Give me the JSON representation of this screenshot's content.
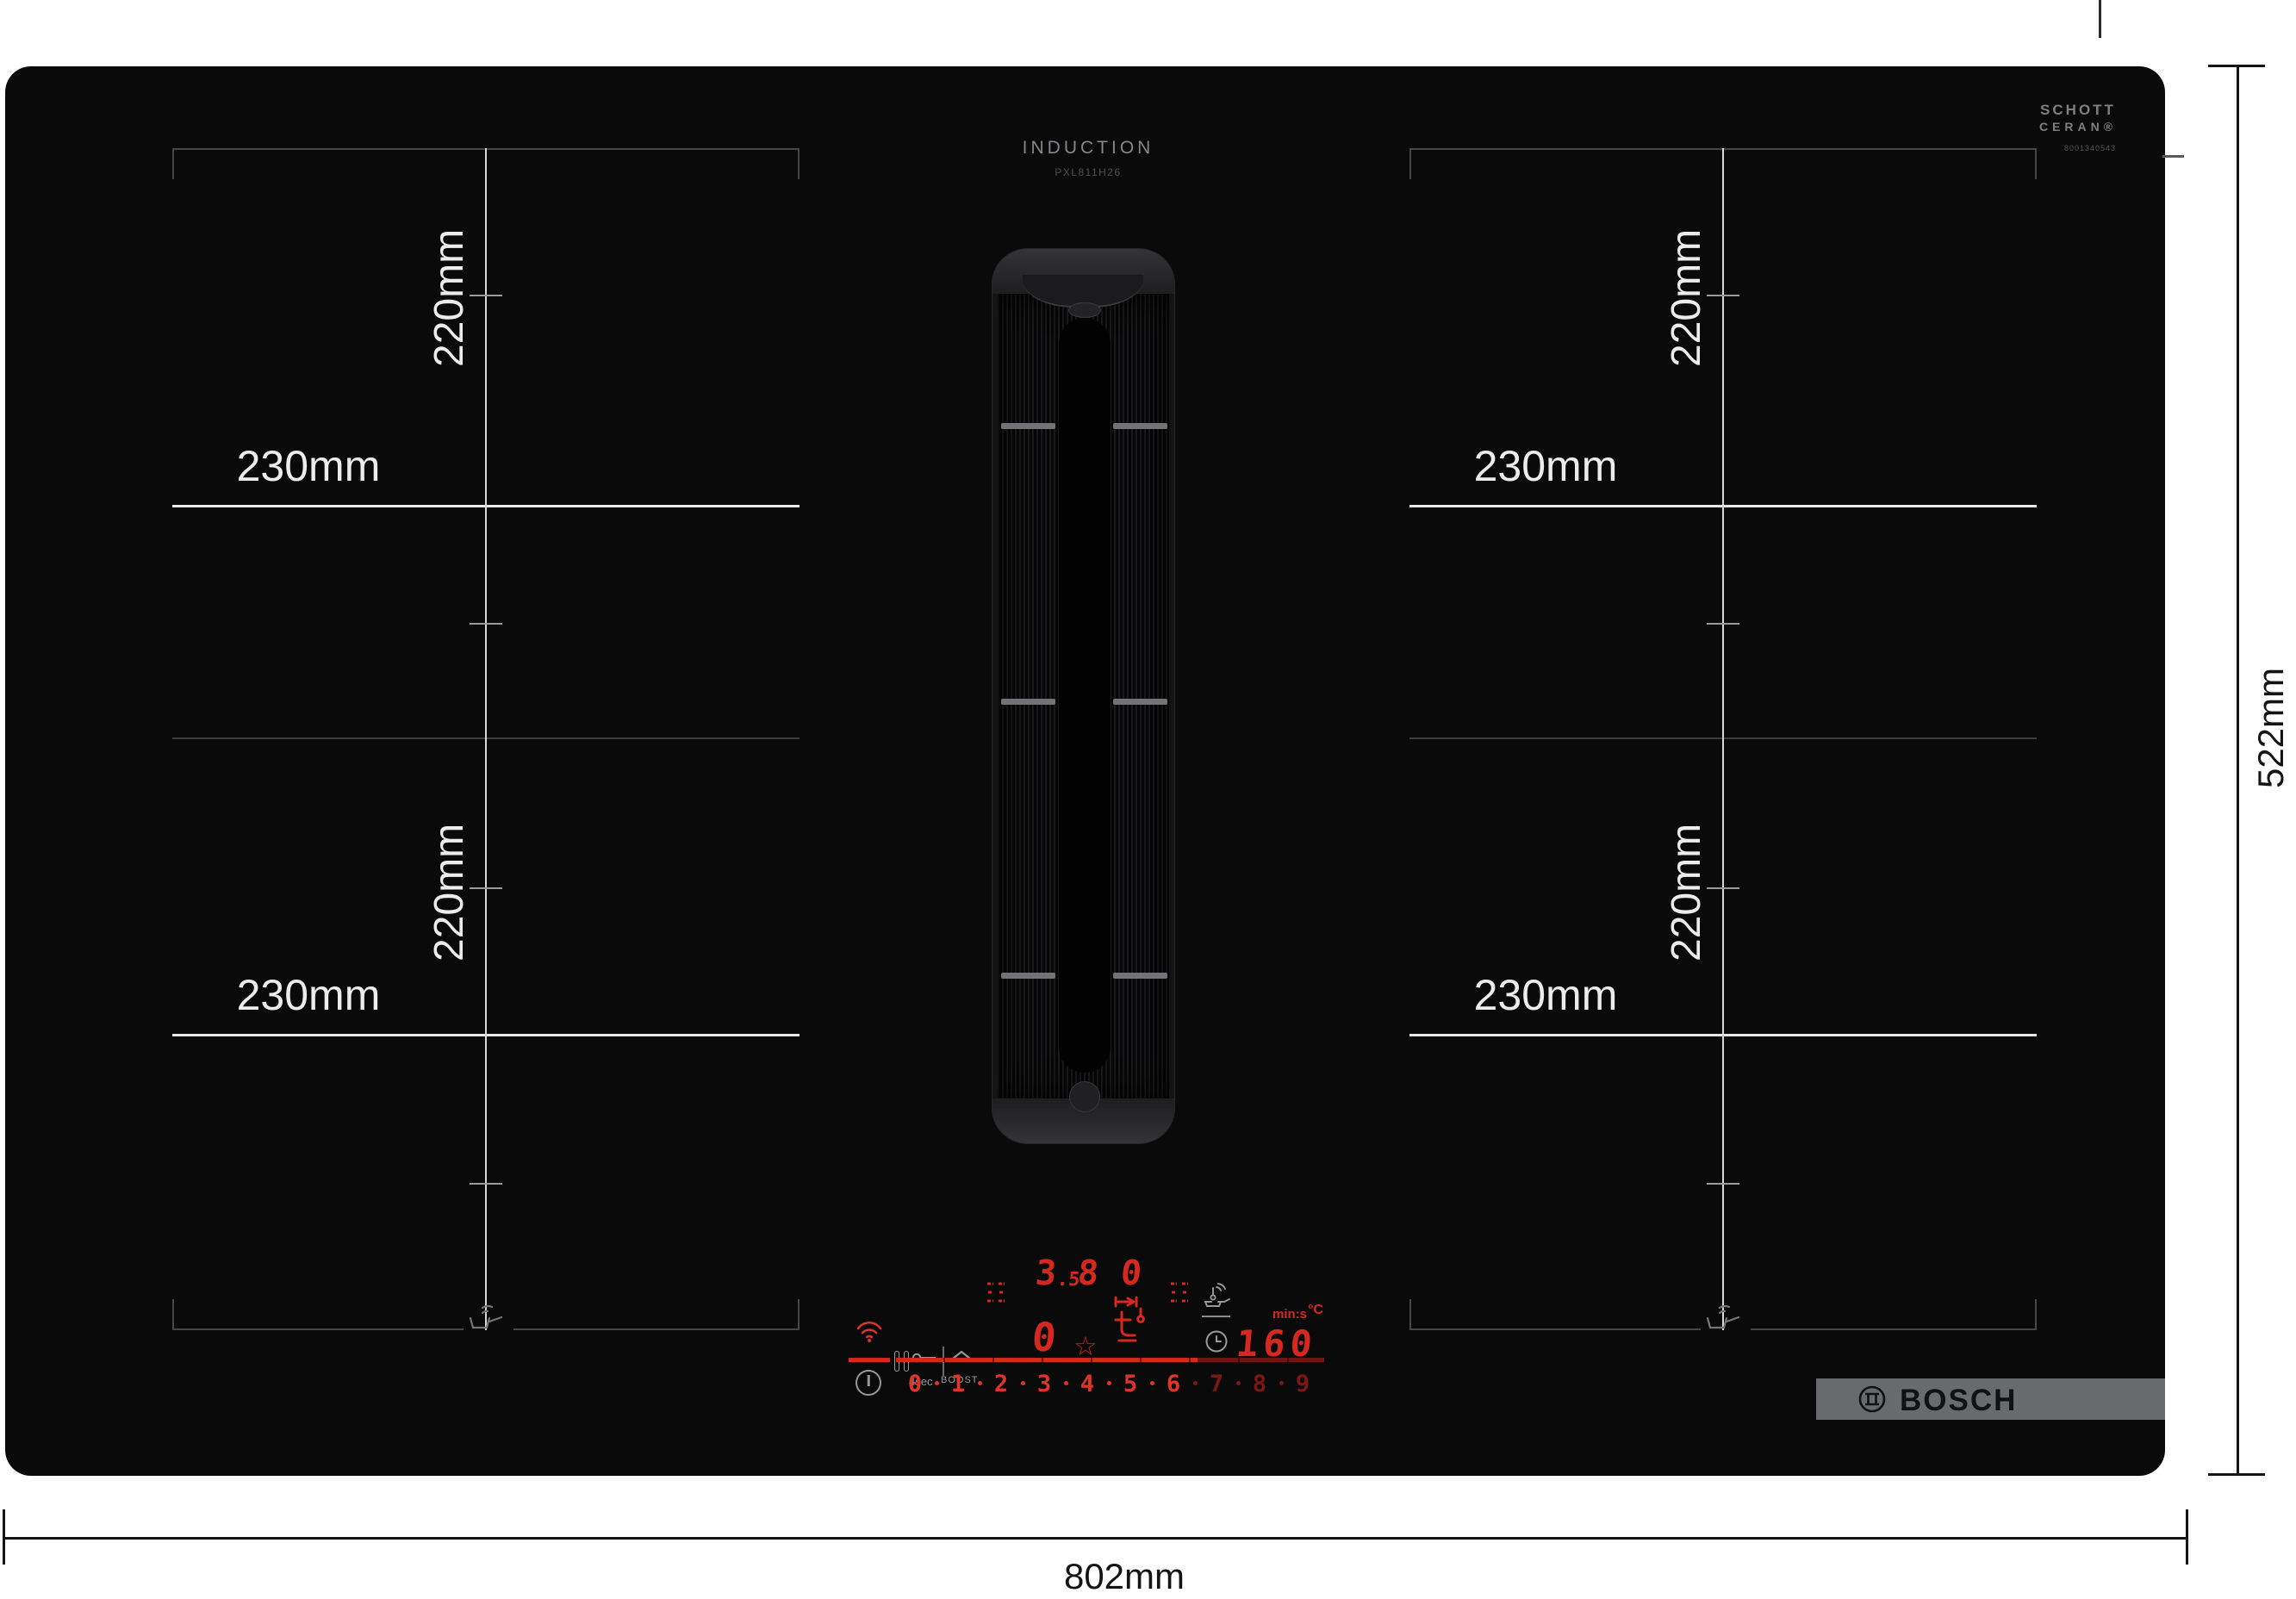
{
  "hob": {
    "print": {
      "title": "INDUCTION",
      "model": "PXL811H26"
    },
    "glass_brand": {
      "line1": "SCHOTT",
      "line2": "CERAN®",
      "serial": "8001340543"
    },
    "brand": {
      "name": "BOSCH"
    }
  },
  "zones": {
    "width_label": "230mm",
    "height_label": "220mm"
  },
  "dimensions": {
    "width": "802mm",
    "depth": "522mm"
  },
  "panel": {
    "hood_display": {
      "main": "3",
      "sub": ".5",
      "digit2": "8",
      "digit3": "0"
    },
    "zone_display": "0",
    "timer_display": "160",
    "timer_unit_time": "min:s",
    "timer_unit_temp": "°C",
    "lock_hold_label": "4sec",
    "boost_label": "BOOST",
    "favorite_icon": "☆",
    "scale": [
      "0",
      "1",
      "2",
      "3",
      "4",
      "5",
      "6",
      "7",
      "8",
      "9"
    ]
  },
  "colors": {
    "led_bright": "#d6281e",
    "led_dim": "#701410",
    "scale_bright": "#e0342a",
    "scale_dim": "#7c1812",
    "icon_gray": "#98989a",
    "zone_line_white": "#e8e8e8",
    "zone_line_gray": "#47474a",
    "logo_band_gray": "#696a6e"
  }
}
